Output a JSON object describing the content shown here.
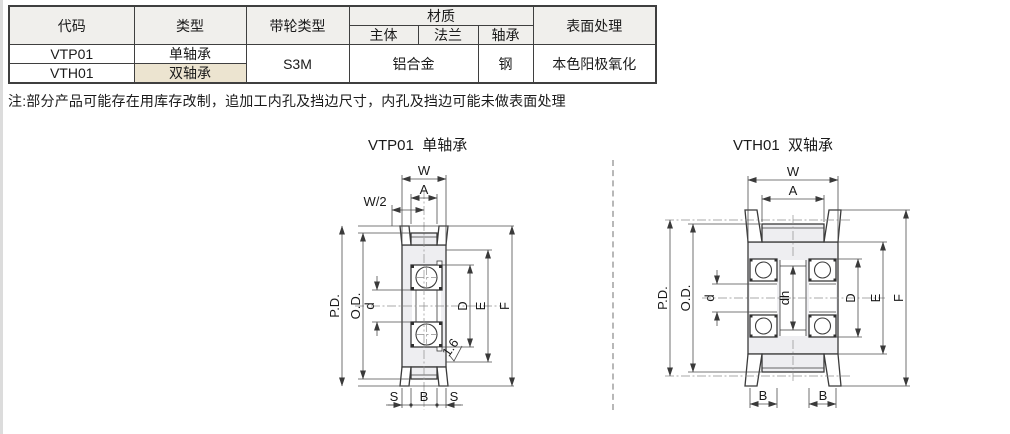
{
  "table": {
    "headers": {
      "code": "代码",
      "type": "类型",
      "pulley_type": "带轮类型",
      "material": "材质",
      "material_body": "主体",
      "material_flange": "法兰",
      "material_bearing": "轴承",
      "surface": "表面处理"
    },
    "rows": [
      {
        "code": "VTP01",
        "type": "单轴承"
      },
      {
        "code": "VTH01",
        "type": "双轴承"
      }
    ],
    "shared": {
      "pulley_type": "S3M",
      "material_body_flange": "铝合金",
      "material_bearing": "钢",
      "surface": "本色阳极氧化"
    }
  },
  "note": "注:部分产品可能存在用库存改制，追加工内孔及挡边尺寸，内孔及挡边可能未做表面处理",
  "diagrams": {
    "left": {
      "title": "VTP01  单轴承",
      "labels": {
        "w": "W",
        "a": "A",
        "w_half": "W/2",
        "pd": "P.D.",
        "od": "O.D.",
        "d": "d",
        "big_d": "D",
        "e": "E",
        "f": "F",
        "s1": "S",
        "b": "B",
        "s2": "S",
        "roughness": "1.6"
      }
    },
    "right": {
      "title": "VTH01  双轴承",
      "labels": {
        "w": "W",
        "a": "A",
        "pd": "P.D.",
        "od": "O.D.",
        "d": "d",
        "dh": "dh",
        "big_d": "D",
        "e": "E",
        "f": "F",
        "b1": "B",
        "b2": "B"
      }
    }
  },
  "colors": {
    "table_border": "#3f3f3f",
    "header_bg": "#f0efec",
    "highlight_bg": "#ece4d0",
    "drawing_line": "#3a3a3a",
    "drawing_fill": "#eeeef1",
    "divider": "#b8b8b8"
  }
}
